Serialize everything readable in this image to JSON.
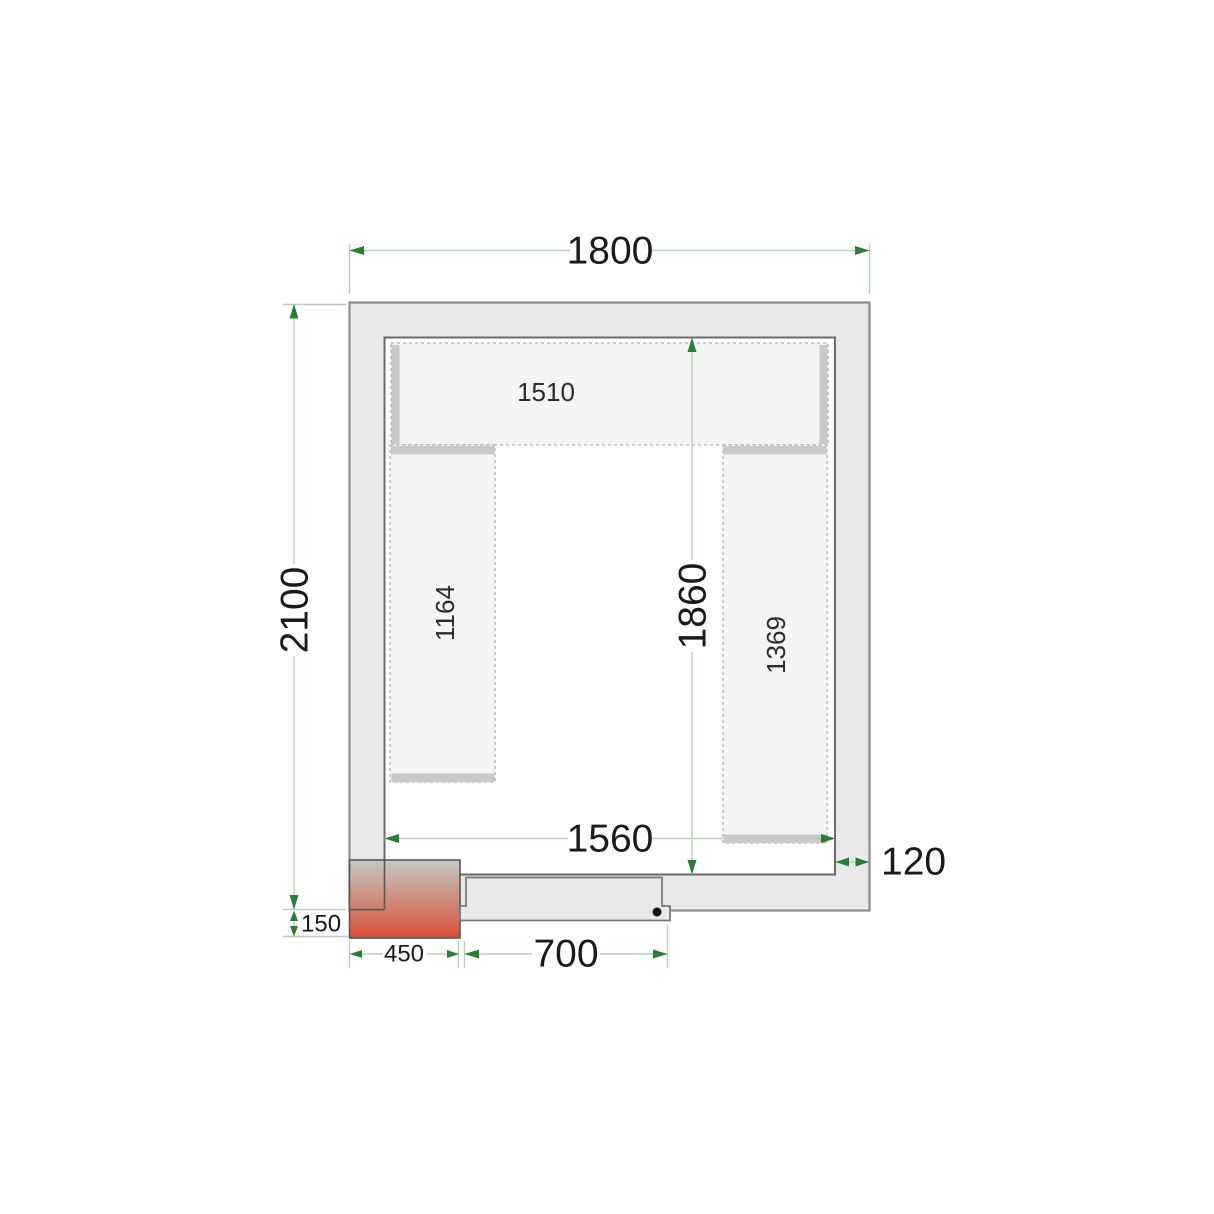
{
  "plan": {
    "outer_width_mm": "1800",
    "outer_depth_mm": "2100",
    "inner_width_mm": "1560",
    "inner_depth_mm": "1860",
    "wall_thickness_mm": "120",
    "door_width_mm": "700",
    "cooling_unit_width_mm": "450",
    "cooling_unit_offset_mm": "150",
    "shelves": {
      "top": "1510",
      "left": "1164",
      "right": "1369"
    }
  },
  "colors": {
    "wall_fill": "#e9e9e9",
    "wall_stroke": "#8c8c8c",
    "room_stroke": "#6a6a6a",
    "shelf_fill": "#f4f4f4",
    "shelf_stroke": "#b0b0b0",
    "bracket": "#c9c9c9",
    "door_stroke": "#787878",
    "handle": "#111111",
    "unit_top": "#c3cac2",
    "unit_bottom": "#d94f38",
    "unit_stroke": "#565656",
    "dim_line": "#b7cfb7",
    "dim_arrow": "#2a7d35",
    "text": "#1a1a1a"
  }
}
